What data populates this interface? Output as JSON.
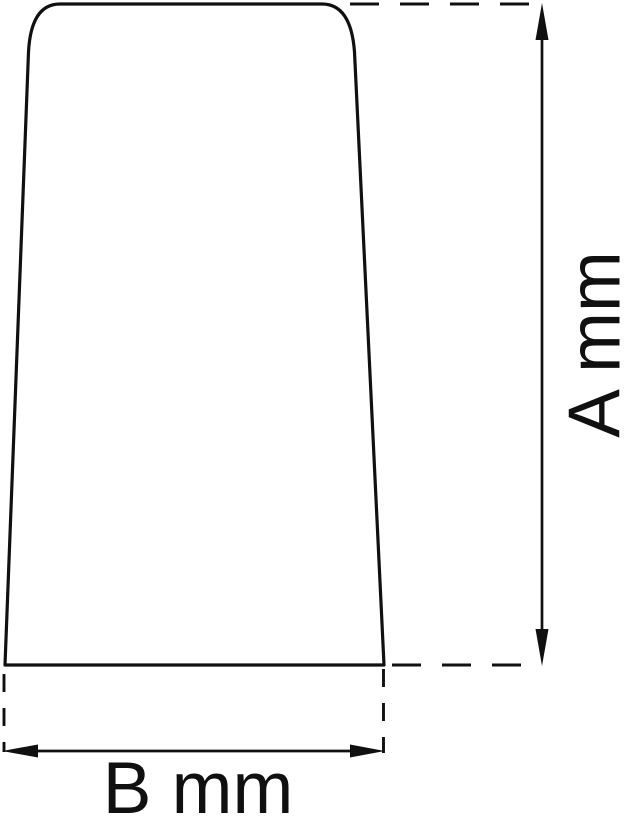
{
  "drawing": {
    "height_dimension": {
      "label": "A mm",
      "orientation": "vertical"
    },
    "width_dimension": {
      "label": "B mm",
      "orientation": "horizontal"
    }
  },
  "colors": {
    "line": "#101010",
    "background": "#ffffff"
  }
}
